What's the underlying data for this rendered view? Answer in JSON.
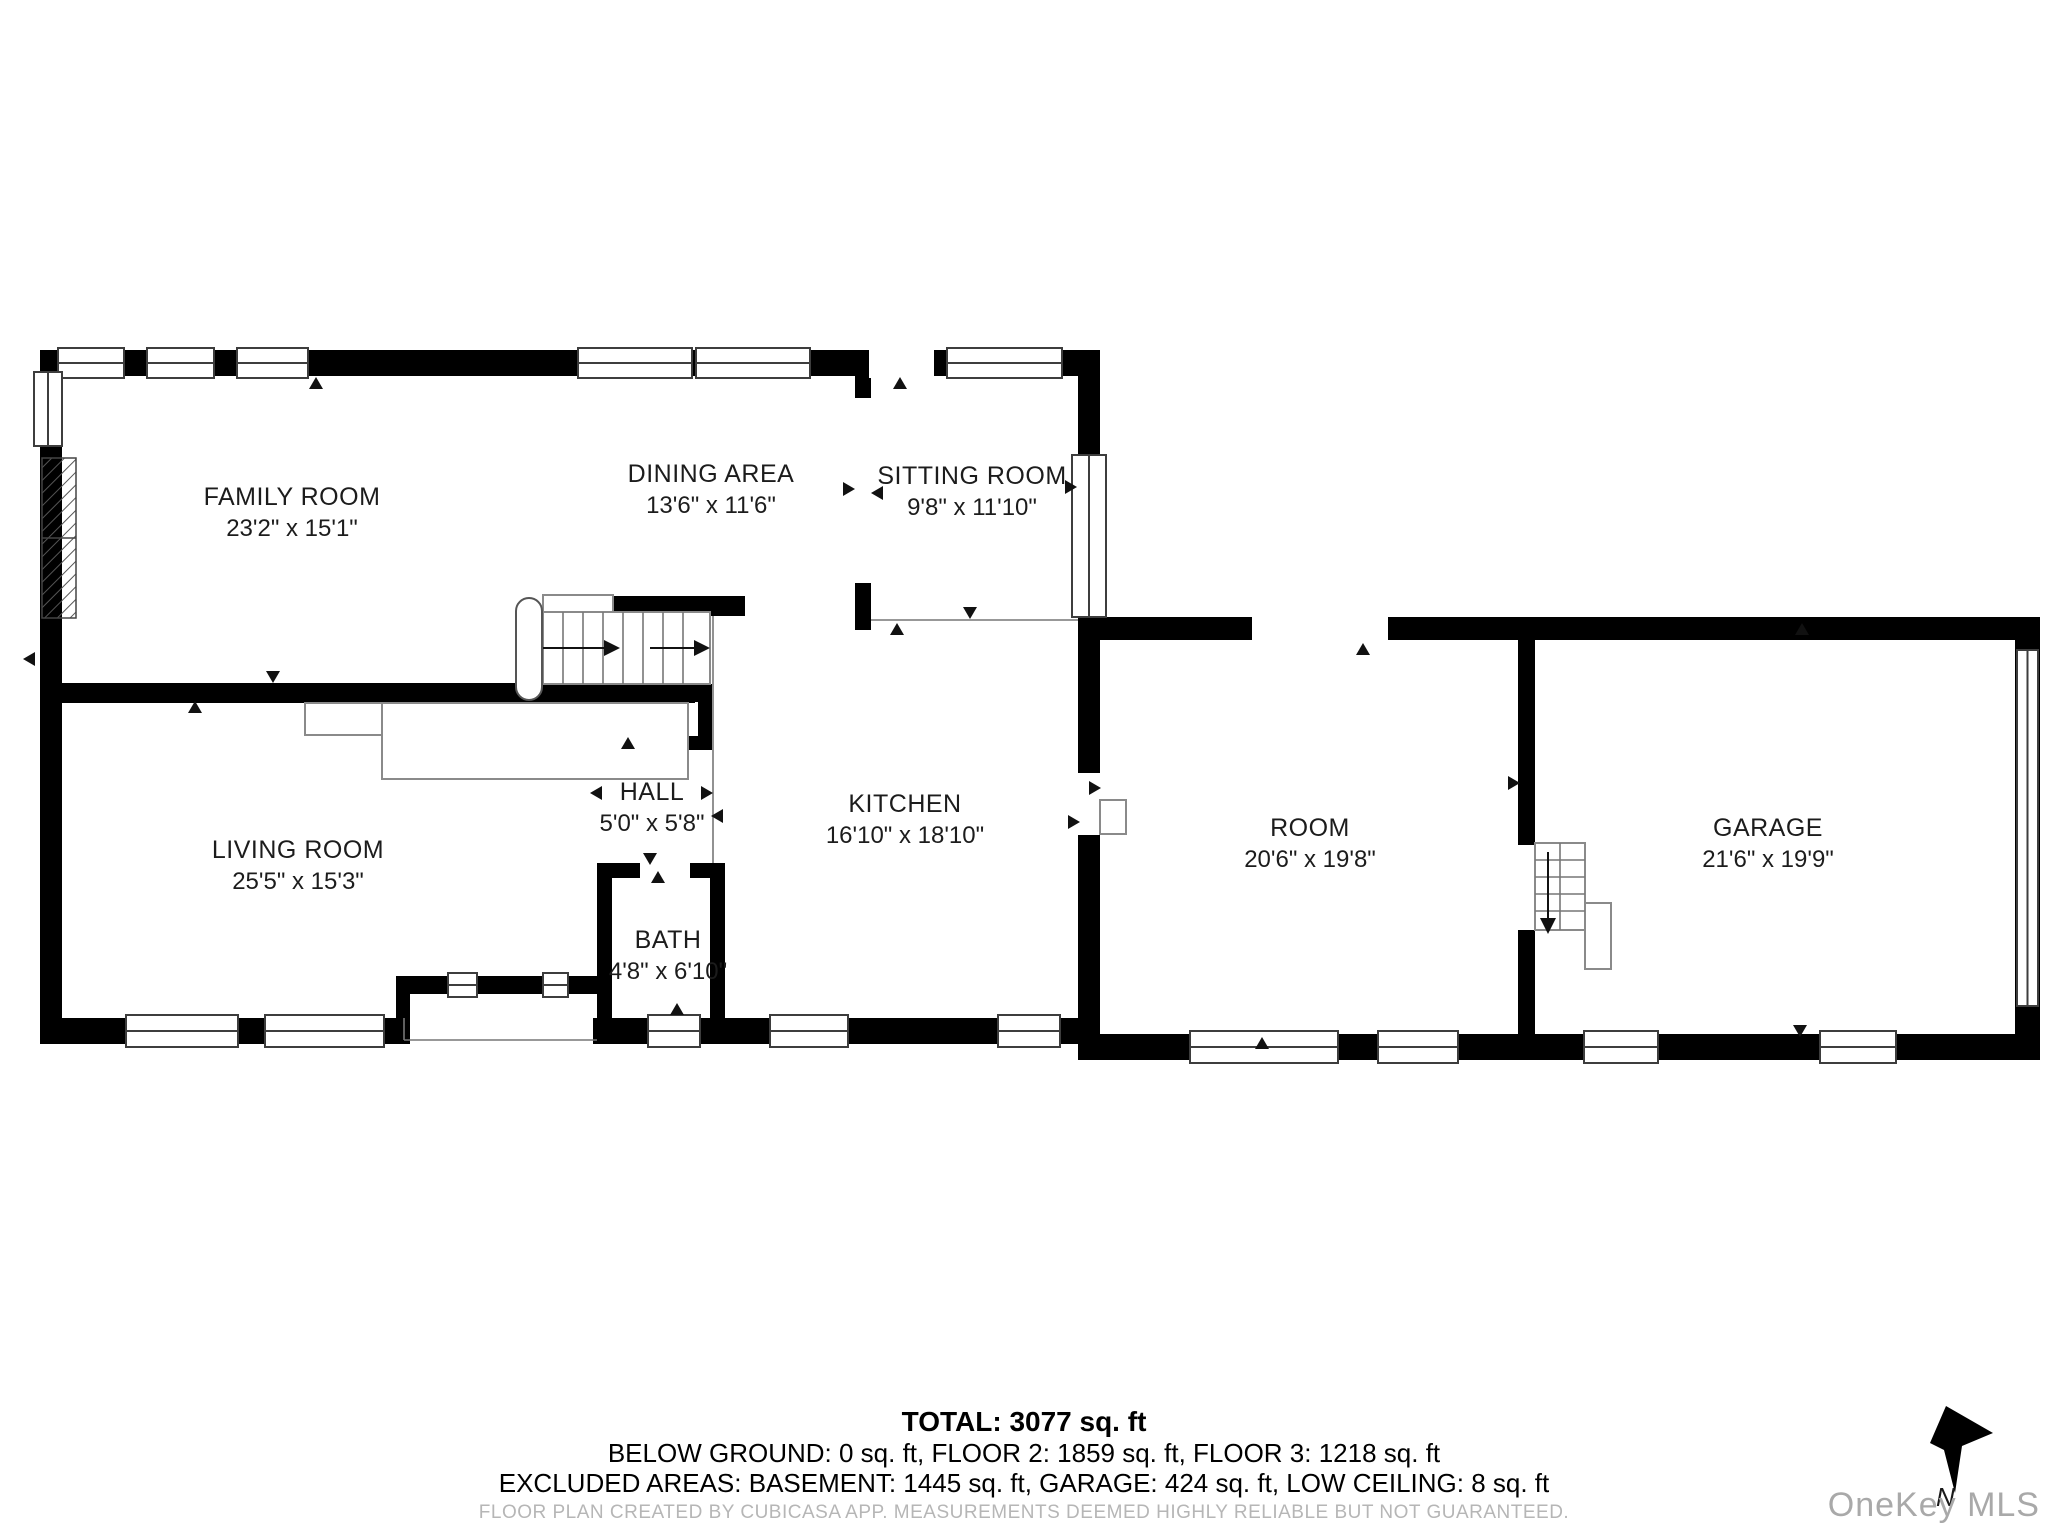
{
  "rooms": {
    "family": {
      "name": "FAMILY ROOM",
      "dims": "23'2\" x 15'1\""
    },
    "dining": {
      "name": "DINING AREA",
      "dims": "13'6\" x 11'6\""
    },
    "sitting": {
      "name": "SITTING ROOM",
      "dims": "9'8\" x 11'10\""
    },
    "living": {
      "name": "LIVING ROOM",
      "dims": "25'5\" x 15'3\""
    },
    "hall": {
      "name": "HALL",
      "dims": "5'0\" x 5'8\""
    },
    "kitchen": {
      "name": "KITCHEN",
      "dims": "16'10\" x 18'10\""
    },
    "bath": {
      "name": "BATH",
      "dims": "4'8\" x 6'10\""
    },
    "room": {
      "name": "ROOM",
      "dims": "20'6\" x 19'8\""
    },
    "garage": {
      "name": "GARAGE",
      "dims": "21'6\" x 19'9\""
    }
  },
  "summary": {
    "total": "TOTAL: 3077 sq. ft",
    "floors": "BELOW GROUND: 0 sq. ft, FLOOR 2: 1859 sq. ft, FLOOR 3: 1218 sq. ft",
    "excluded": "EXCLUDED AREAS: BASEMENT: 1445 sq. ft, GARAGE: 424 sq. ft, LOW CEILING: 8 sq. ft",
    "disclaimer": "FLOOR PLAN CREATED BY CUBICASA APP. MEASUREMENTS DEEMED HIGHLY RELIABLE BUT NOT GUARANTEED."
  },
  "branding": {
    "logo": "OneKey MLS",
    "north_label": "N"
  },
  "colors": {
    "wall": "#000000",
    "thin_line": "#8a8a8a",
    "label": "#1c1c1c",
    "disclaimer": "#b6b6b6",
    "logo": "#a9a9a9"
  }
}
